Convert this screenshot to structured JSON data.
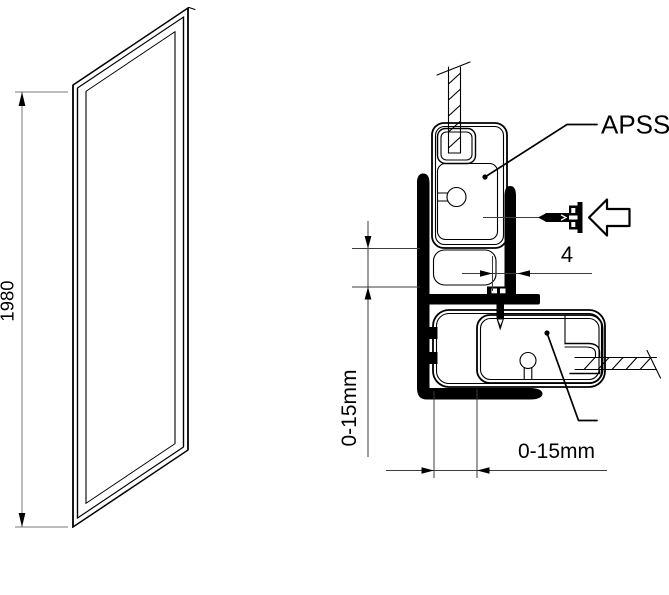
{
  "colors": {
    "background": "#ffffff",
    "ink": "#000000",
    "dimension_line": "#7a7a7a"
  },
  "left_view": {
    "description": "glass side panel perspective view",
    "height_dimension": "1980"
  },
  "detail_view": {
    "description": "wall profile cross-section mounting detail",
    "profile_label": "APSS",
    "screw_gap_dimension": "4",
    "vertical_adjustment_dimension": "0-15mm",
    "horizontal_adjustment_dimension": "0-15mm"
  }
}
